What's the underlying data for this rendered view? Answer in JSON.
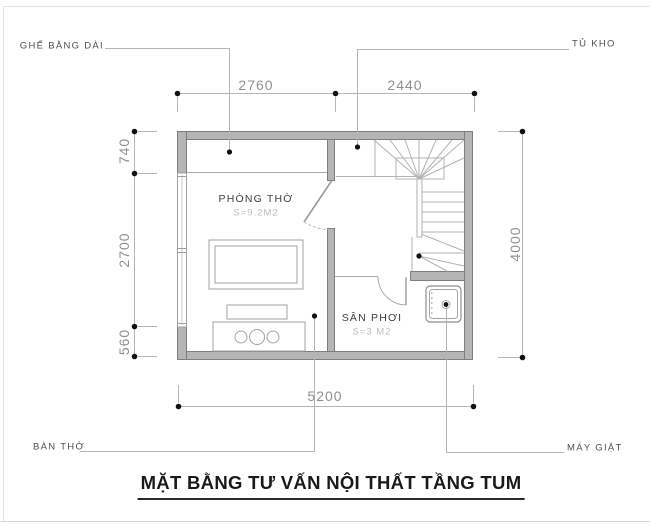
{
  "title": "MẶT BẰNG TƯ VẤN NỘI THẤT TẦNG TUM",
  "annotations": {
    "bench": "GHẾ BẰNG DÀI",
    "storage_cabinet": "TỦ KHO",
    "altar": "BÀN THỜ",
    "washing_machine": "MÁY GIẶT"
  },
  "rooms": [
    {
      "name": "PHÒNG THỜ",
      "area": "S=9.2M2"
    },
    {
      "name": "SÂN PHƠI",
      "area": "S=3 M2"
    }
  ],
  "dimensions": {
    "top": [
      "2760",
      "2440"
    ],
    "left": [
      "740",
      "2700",
      "560"
    ],
    "right": [
      "4000"
    ],
    "bottom": [
      "5200"
    ]
  },
  "icons": {
    "washing_machine": "washing-machine-icon",
    "stairs": "staircase-symbol",
    "doors": "door-swing-symbol",
    "window": "window-symbol"
  },
  "colors": {
    "wall_fill": "#b5b5b5",
    "wall_stroke": "#7e7e7e",
    "thin_line": "#b3b3b3",
    "dim_text": "#8f8f8f",
    "label_text": "#4f4f4f",
    "area_text": "#bdbdbd",
    "title_text": "#1a1a1a",
    "dot": "#111111"
  }
}
